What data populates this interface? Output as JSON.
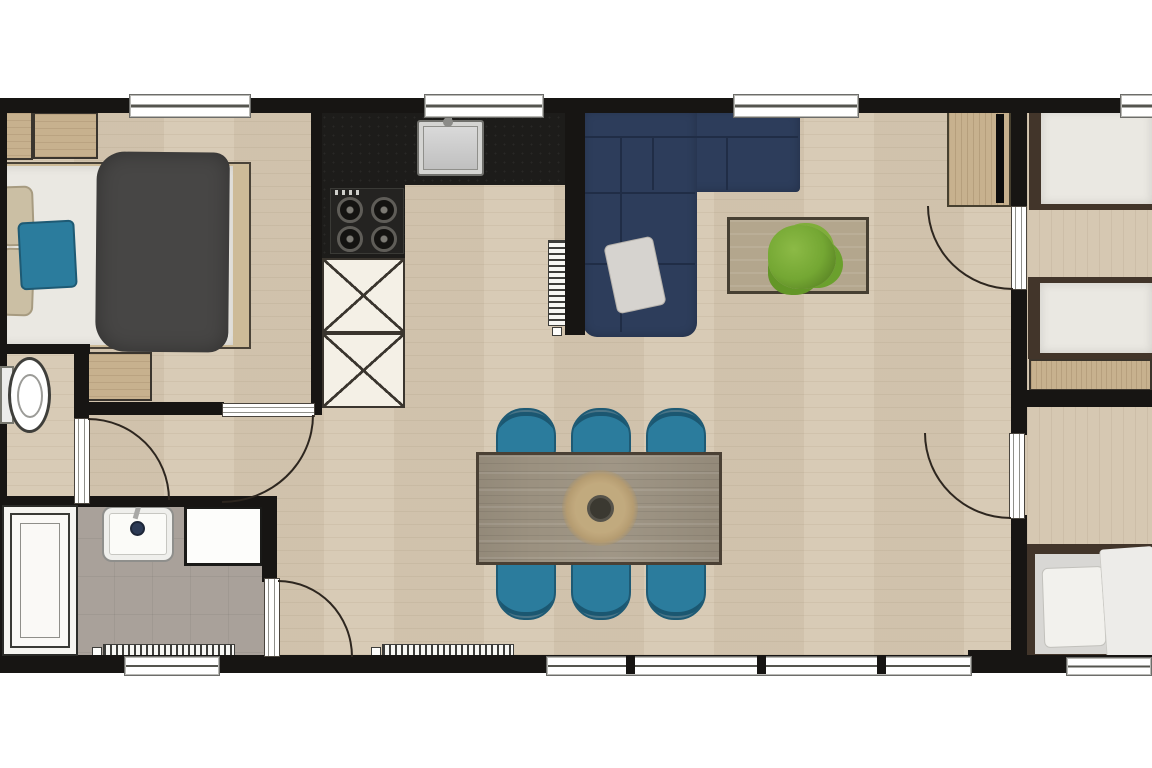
{
  "meta": {
    "type": "floor-plan",
    "view": "top-down 2D",
    "visible_text": ""
  },
  "colors": {
    "background": "#ffffff",
    "wall": "#171513",
    "floor_wood": "#d6c8b2",
    "floor_tile": "#a9a19a",
    "counter": "#1d1c1a",
    "stove": "#242321",
    "burner": "#5f5d58",
    "cabinet_white": "#f4f0e6",
    "line_dark": "#3a352e",
    "wood": "#c7b18e",
    "wood_dark": "#4a4034",
    "sofa": "#2d3d5b",
    "sofa_seam": "#202d46",
    "teal": "#2b7c9d",
    "teal_dark": "#1e5a74",
    "duvet_gray": "#474645",
    "mattress": "#eae8e2",
    "mattress_gray": "#d8d7d4",
    "pillow_beige": "#cbbfa4",
    "frame_brown": "#42352a",
    "table_wood": "#9b9180",
    "coffee_wood": "#b3a68d",
    "plant": "#74a733",
    "placemat": "#c8b084",
    "bowl": "#3b3931",
    "steel": "#c9c9c7",
    "door_line": "#2d261f",
    "radiator": "#f7f7f4",
    "window": "#ffffff",
    "shower": "#f5f4f0",
    "tv": "#0d0d0d"
  },
  "plan": {
    "rooms": [
      {
        "name": "master-bedroom",
        "furniture": [
          "wardrobe",
          "double-bed",
          "beige-pillows",
          "teal-cushion",
          "dark-duvet",
          "side-wardrobe"
        ]
      },
      {
        "name": "wc",
        "furniture": [
          "toilet"
        ]
      },
      {
        "name": "bathroom",
        "furniture": [
          "shower",
          "washbasin",
          "cabinet",
          "radiator"
        ]
      },
      {
        "name": "kitchen",
        "furniture": [
          "black-l-counter",
          "sink",
          "gas-hob",
          "base-cabinets"
        ]
      },
      {
        "name": "living-dining",
        "furniture": [
          "corner-sofa",
          "scatter-cushion",
          "coffee-table",
          "plant",
          "tv-cabinet",
          "dining-table",
          "dining-chairs",
          "placemat",
          "bowl",
          "radiators"
        ]
      },
      {
        "name": "bedroom-2",
        "furniture": [
          "single-bed",
          "single-bed",
          "low-wardrobe"
        ]
      },
      {
        "name": "bedroom-3",
        "furniture": [
          "single-bed",
          "white-duvet",
          "pillow"
        ]
      }
    ],
    "counts": {
      "window_openings": 7,
      "doors": 5,
      "dining_chairs": 6,
      "hob_burners": 4,
      "single_beds": 3,
      "double_beds": 1
    }
  }
}
